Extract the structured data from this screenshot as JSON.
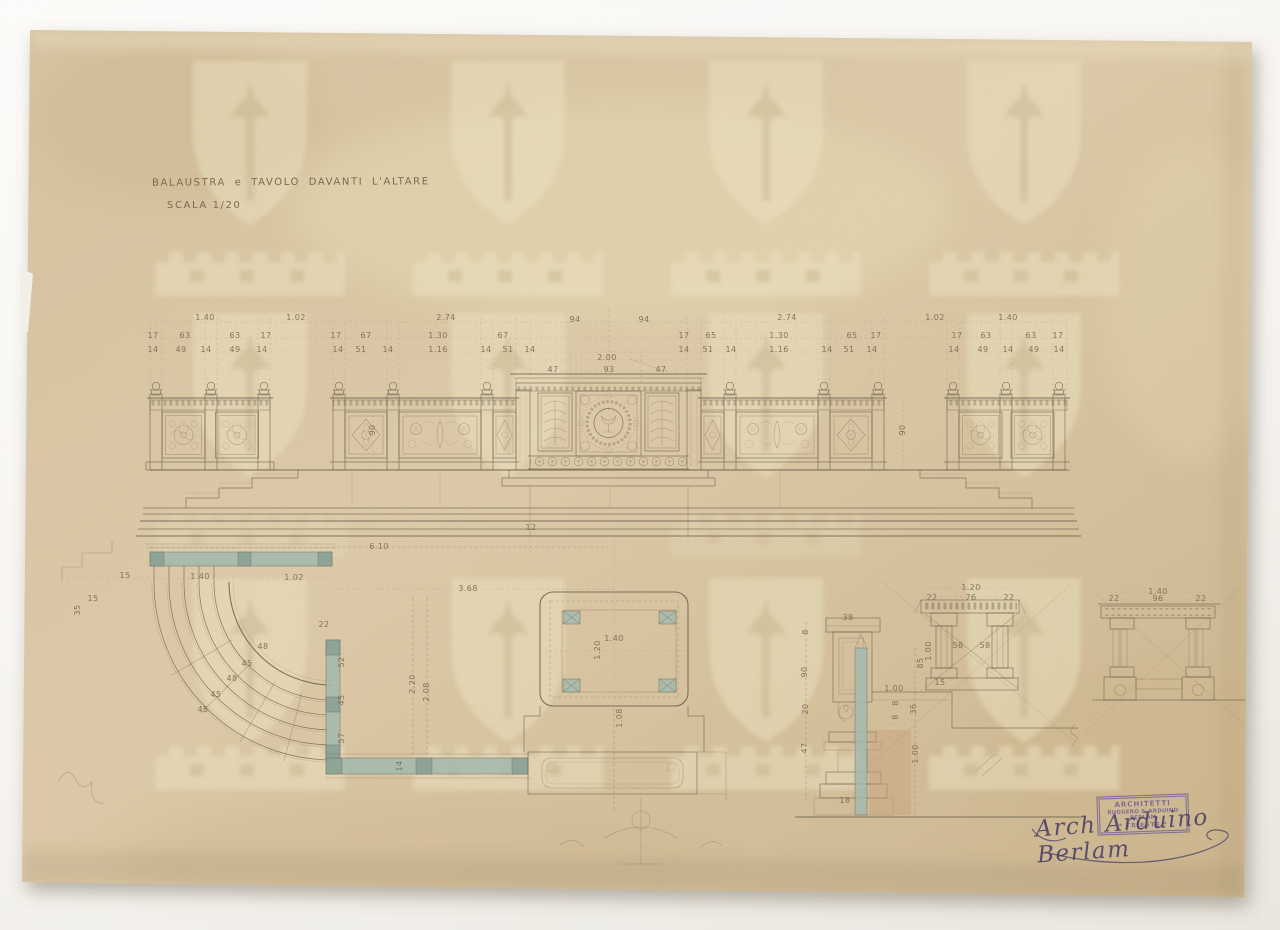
{
  "document": {
    "title": "BALAUSTRA e TAVOLO DAVANTI L'ALTARE",
    "scale_note": "SCALA 1/20",
    "stamp": {
      "line1": "ARCHITETTI",
      "line2": "RUGGERO & ARDUINO BERLAM",
      "line3": "* TRIESTE *"
    },
    "signature": "Arch Arduino Berlam"
  },
  "colors": {
    "paper": "#d9c6a4",
    "ink": "#6a5f4c",
    "dim_text": "#796952",
    "wash_blue": "#a3bab0",
    "wash_blue_dark": "#8aa297",
    "wash_tan": "#c6a379",
    "stamp_purple": "#6f5f93",
    "signature_ink": "#4a3e66",
    "photo_bg": "#f6f4f0"
  },
  "dim_labels": [
    {
      "x": 205,
      "y": 318,
      "t": "1.40"
    },
    {
      "x": 296,
      "y": 318,
      "t": "1.02"
    },
    {
      "x": 446,
      "y": 318,
      "t": "2.74"
    },
    {
      "x": 575,
      "y": 320,
      "t": "94"
    },
    {
      "x": 644,
      "y": 320,
      "t": "94"
    },
    {
      "x": 787,
      "y": 318,
      "t": "2.74"
    },
    {
      "x": 935,
      "y": 318,
      "t": "1.02"
    },
    {
      "x": 1008,
      "y": 318,
      "t": "1.40"
    },
    {
      "x": 153,
      "y": 336,
      "t": "17"
    },
    {
      "x": 185,
      "y": 336,
      "t": "63"
    },
    {
      "x": 235,
      "y": 336,
      "t": "63"
    },
    {
      "x": 266,
      "y": 336,
      "t": "17"
    },
    {
      "x": 336,
      "y": 336,
      "t": "17"
    },
    {
      "x": 366,
      "y": 336,
      "t": "67"
    },
    {
      "x": 438,
      "y": 336,
      "t": "1.30"
    },
    {
      "x": 503,
      "y": 336,
      "t": "67"
    },
    {
      "x": 684,
      "y": 336,
      "t": "17"
    },
    {
      "x": 711,
      "y": 336,
      "t": "65"
    },
    {
      "x": 779,
      "y": 336,
      "t": "1.30"
    },
    {
      "x": 852,
      "y": 336,
      "t": "65"
    },
    {
      "x": 876,
      "y": 336,
      "t": "17"
    },
    {
      "x": 957,
      "y": 336,
      "t": "17"
    },
    {
      "x": 986,
      "y": 336,
      "t": "63"
    },
    {
      "x": 1031,
      "y": 336,
      "t": "63"
    },
    {
      "x": 1058,
      "y": 336,
      "t": "17"
    },
    {
      "x": 153,
      "y": 350,
      "t": "14"
    },
    {
      "x": 181,
      "y": 350,
      "t": "49"
    },
    {
      "x": 206,
      "y": 350,
      "t": "14"
    },
    {
      "x": 235,
      "y": 350,
      "t": "49"
    },
    {
      "x": 262,
      "y": 350,
      "t": "14"
    },
    {
      "x": 338,
      "y": 350,
      "t": "14"
    },
    {
      "x": 361,
      "y": 350,
      "t": "51"
    },
    {
      "x": 388,
      "y": 350,
      "t": "14"
    },
    {
      "x": 438,
      "y": 350,
      "t": "1.16"
    },
    {
      "x": 486,
      "y": 350,
      "t": "14"
    },
    {
      "x": 508,
      "y": 350,
      "t": "51"
    },
    {
      "x": 530,
      "y": 350,
      "t": "14"
    },
    {
      "x": 684,
      "y": 350,
      "t": "14"
    },
    {
      "x": 708,
      "y": 350,
      "t": "51"
    },
    {
      "x": 731,
      "y": 350,
      "t": "14"
    },
    {
      "x": 779,
      "y": 350,
      "t": "1.16"
    },
    {
      "x": 827,
      "y": 350,
      "t": "14"
    },
    {
      "x": 849,
      "y": 350,
      "t": "51"
    },
    {
      "x": 872,
      "y": 350,
      "t": "14"
    },
    {
      "x": 954,
      "y": 350,
      "t": "14"
    },
    {
      "x": 983,
      "y": 350,
      "t": "49"
    },
    {
      "x": 1008,
      "y": 350,
      "t": "14"
    },
    {
      "x": 1034,
      "y": 350,
      "t": "49"
    },
    {
      "x": 1059,
      "y": 350,
      "t": "14"
    },
    {
      "x": 607,
      "y": 358,
      "t": "2.00"
    },
    {
      "x": 553,
      "y": 370,
      "t": "47"
    },
    {
      "x": 609,
      "y": 370,
      "t": "93"
    },
    {
      "x": 661,
      "y": 370,
      "t": "47"
    },
    {
      "x": 373,
      "y": 430,
      "t": "90",
      "r": 1
    },
    {
      "x": 903,
      "y": 430,
      "t": "90",
      "r": 1
    },
    {
      "x": 379,
      "y": 547,
      "t": "6.10"
    },
    {
      "x": 531,
      "y": 528,
      "t": "12"
    },
    {
      "x": 125,
      "y": 576,
      "t": "15"
    },
    {
      "x": 93,
      "y": 599,
      "t": "15"
    },
    {
      "x": 78,
      "y": 610,
      "t": "35",
      "r": 1
    },
    {
      "x": 200,
      "y": 577,
      "t": "1.40"
    },
    {
      "x": 294,
      "y": 578,
      "t": "1.02"
    },
    {
      "x": 468,
      "y": 589,
      "t": "3.68"
    },
    {
      "x": 324,
      "y": 625,
      "t": "22"
    },
    {
      "x": 413,
      "y": 684,
      "t": "2.20",
      "r": 1
    },
    {
      "x": 427,
      "y": 692,
      "t": "2.08",
      "r": 1
    },
    {
      "x": 263,
      "y": 647,
      "t": "48"
    },
    {
      "x": 247,
      "y": 664,
      "t": "45"
    },
    {
      "x": 232,
      "y": 679,
      "t": "48"
    },
    {
      "x": 216,
      "y": 695,
      "t": "45"
    },
    {
      "x": 203,
      "y": 710,
      "t": "45"
    },
    {
      "x": 342,
      "y": 662,
      "t": "52",
      "r": 1
    },
    {
      "x": 342,
      "y": 700,
      "t": "45",
      "r": 1
    },
    {
      "x": 342,
      "y": 738,
      "t": "57",
      "r": 1
    },
    {
      "x": 400,
      "y": 766,
      "t": "14",
      "r": 1
    },
    {
      "x": 614,
      "y": 639,
      "t": "1.40"
    },
    {
      "x": 598,
      "y": 650,
      "t": "1.20",
      "r": 1
    },
    {
      "x": 620,
      "y": 718,
      "t": "1.08",
      "r": 1
    },
    {
      "x": 848,
      "y": 618,
      "t": "38"
    },
    {
      "x": 806,
      "y": 632,
      "t": "8",
      "r": 1
    },
    {
      "x": 805,
      "y": 672,
      "t": "90",
      "r": 1
    },
    {
      "x": 806,
      "y": 709,
      "t": "20",
      "r": 1
    },
    {
      "x": 805,
      "y": 748,
      "t": "47",
      "r": 1
    },
    {
      "x": 845,
      "y": 801,
      "t": "18"
    },
    {
      "x": 894,
      "y": 689,
      "t": "1.00"
    },
    {
      "x": 896,
      "y": 703,
      "t": "8",
      "r": 1
    },
    {
      "x": 896,
      "y": 717,
      "t": "8",
      "r": 1
    },
    {
      "x": 914,
      "y": 709,
      "t": "36",
      "r": 1
    },
    {
      "x": 916,
      "y": 754,
      "t": "1.00",
      "r": 1
    },
    {
      "x": 971,
      "y": 588,
      "t": "1.20"
    },
    {
      "x": 932,
      "y": 598,
      "t": "22"
    },
    {
      "x": 971,
      "y": 598,
      "t": "76"
    },
    {
      "x": 1009,
      "y": 598,
      "t": "22"
    },
    {
      "x": 958,
      "y": 646,
      "t": "58"
    },
    {
      "x": 985,
      "y": 646,
      "t": "58"
    },
    {
      "x": 921,
      "y": 663,
      "t": "85",
      "r": 1
    },
    {
      "x": 929,
      "y": 651,
      "t": "1.00",
      "r": 1
    },
    {
      "x": 940,
      "y": 683,
      "t": "15"
    },
    {
      "x": 1158,
      "y": 592,
      "t": "1.40"
    },
    {
      "x": 1114,
      "y": 599,
      "t": "22"
    },
    {
      "x": 1158,
      "y": 599,
      "t": "96"
    },
    {
      "x": 1201,
      "y": 599,
      "t": "22"
    }
  ]
}
